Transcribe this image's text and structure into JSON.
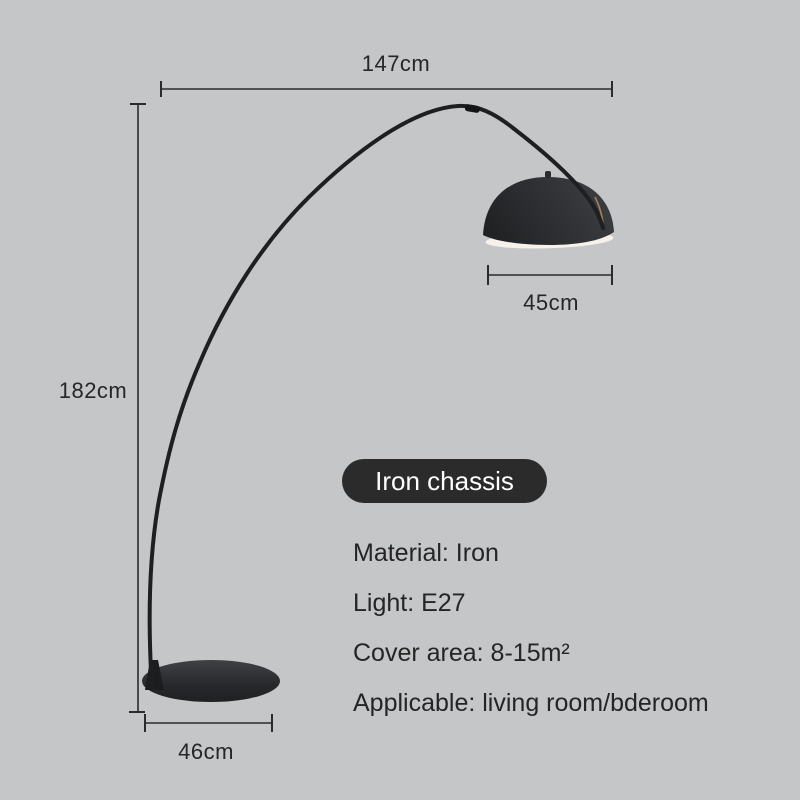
{
  "colors": {
    "background": "#c5c6c8",
    "text": "#262626",
    "dimension_line": "#2b2b2b",
    "badge_background": "#2b2b2b",
    "badge_text": "#ffffff",
    "lamp_black": "#1e1f22",
    "shade_inner": "#f6f2e9"
  },
  "dimensions": {
    "total_width": "147cm",
    "total_height": "182cm",
    "shade_width": "45cm",
    "base_width": "46cm"
  },
  "badge": {
    "label": "Iron chassis"
  },
  "specs": [
    {
      "label": "Material: Iron"
    },
    {
      "label": "Light: E27"
    },
    {
      "label": "Cover area: 8-15m²"
    },
    {
      "label": "Applicable: living room/bderoom"
    }
  ]
}
